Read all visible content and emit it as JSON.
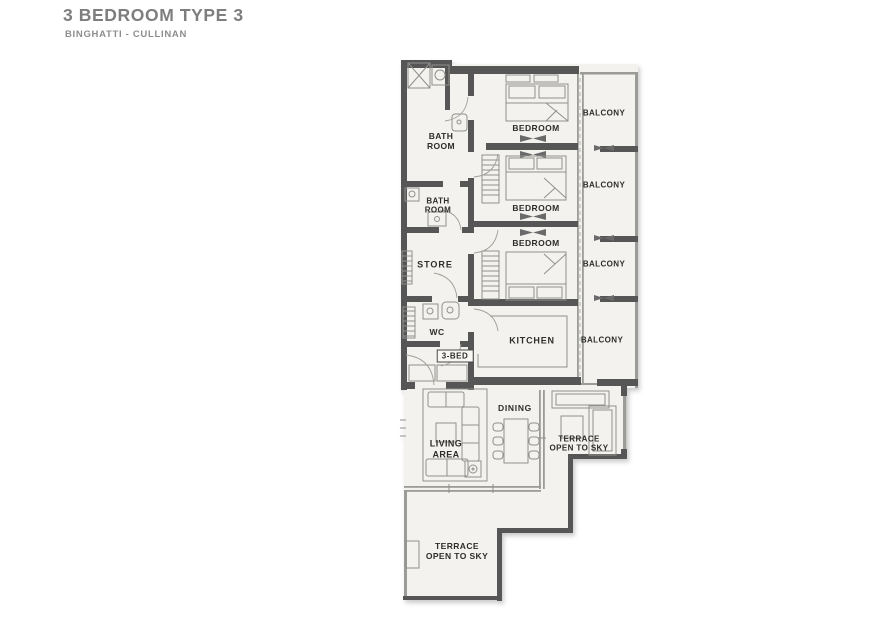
{
  "header": {
    "title": "3 BEDROOM TYPE 3",
    "subtitle": "BINGHATTI - CULLINAN"
  },
  "floorplan": {
    "unit_tag": "3-BED",
    "rooms": {
      "bathroom_1": {
        "label": "BATH\nROOM"
      },
      "bedroom_1": {
        "label": "BEDROOM"
      },
      "balcony_1": {
        "label": "BALCONY"
      },
      "bathroom_2": {
        "label": "BATH\nROOM"
      },
      "bedroom_2": {
        "label": "BEDROOM"
      },
      "balcony_2": {
        "label": "BALCONY"
      },
      "bedroom_3": {
        "label": "BEDROOM"
      },
      "store": {
        "label": "STORE"
      },
      "balcony_3": {
        "label": "BALCONY"
      },
      "wc": {
        "label": "WC"
      },
      "kitchen": {
        "label": "KITCHEN"
      },
      "balcony_4": {
        "label": "BALCONY"
      },
      "dining": {
        "label": "DINING"
      },
      "living_area": {
        "label": "LIVING\nAREA"
      },
      "terrace_right": {
        "label": "TERRACE\nOPEN TO SKY"
      },
      "terrace_bottom": {
        "label": "TERRACE\nOPEN TO SKY"
      }
    }
  },
  "colors": {
    "wall": "#565656",
    "floor": "#f3f2ee",
    "line": "#90908c",
    "label-text": "#2d2d2d",
    "title-text": "#7e7e7e",
    "subtitle-text": "#8d8d8d"
  }
}
